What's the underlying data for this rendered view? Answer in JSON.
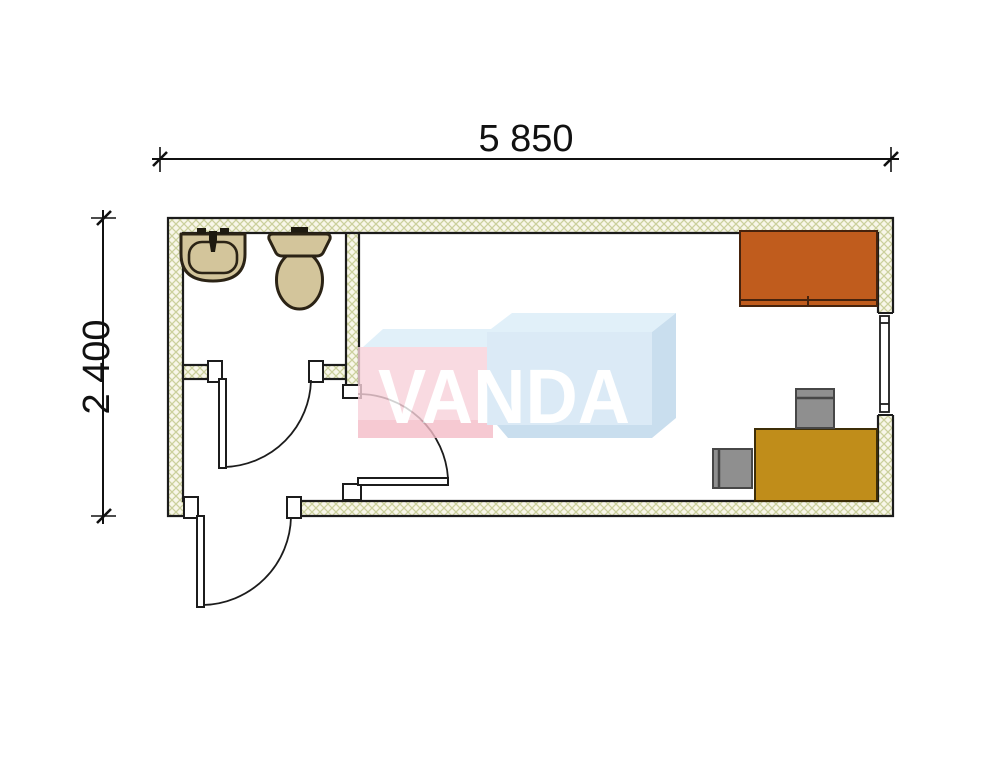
{
  "plan": {
    "width_dimension": "5 850",
    "height_dimension": "2 400",
    "watermark_text": "VANDA",
    "fixtures": [
      "sink",
      "toilet",
      "bathroom-door",
      "entrance-door",
      "room-door",
      "window",
      "wardrobe",
      "desk",
      "chair",
      "chair"
    ],
    "colors": {
      "line": "#1c1c1c",
      "wall_fill": "#f8f6e9",
      "wall_hatch": "#cbd09c",
      "fixture": "#d3c59b",
      "fixture_line": "#2b2315",
      "faucet": "#1e1a10",
      "wardrobe": "#c05c1d",
      "desk": "#c08d1a",
      "chair": "#8f8f8f",
      "white": "#ffffff",
      "wm_pink": "#f8d2da",
      "wm_pink_deep": "#f5bcc8",
      "wm_blue": "#d3e6f4",
      "wm_blue_light": "#daedf8",
      "wm_blue_deep": "#bcd6ea",
      "wm_text": "#ffffff"
    }
  }
}
